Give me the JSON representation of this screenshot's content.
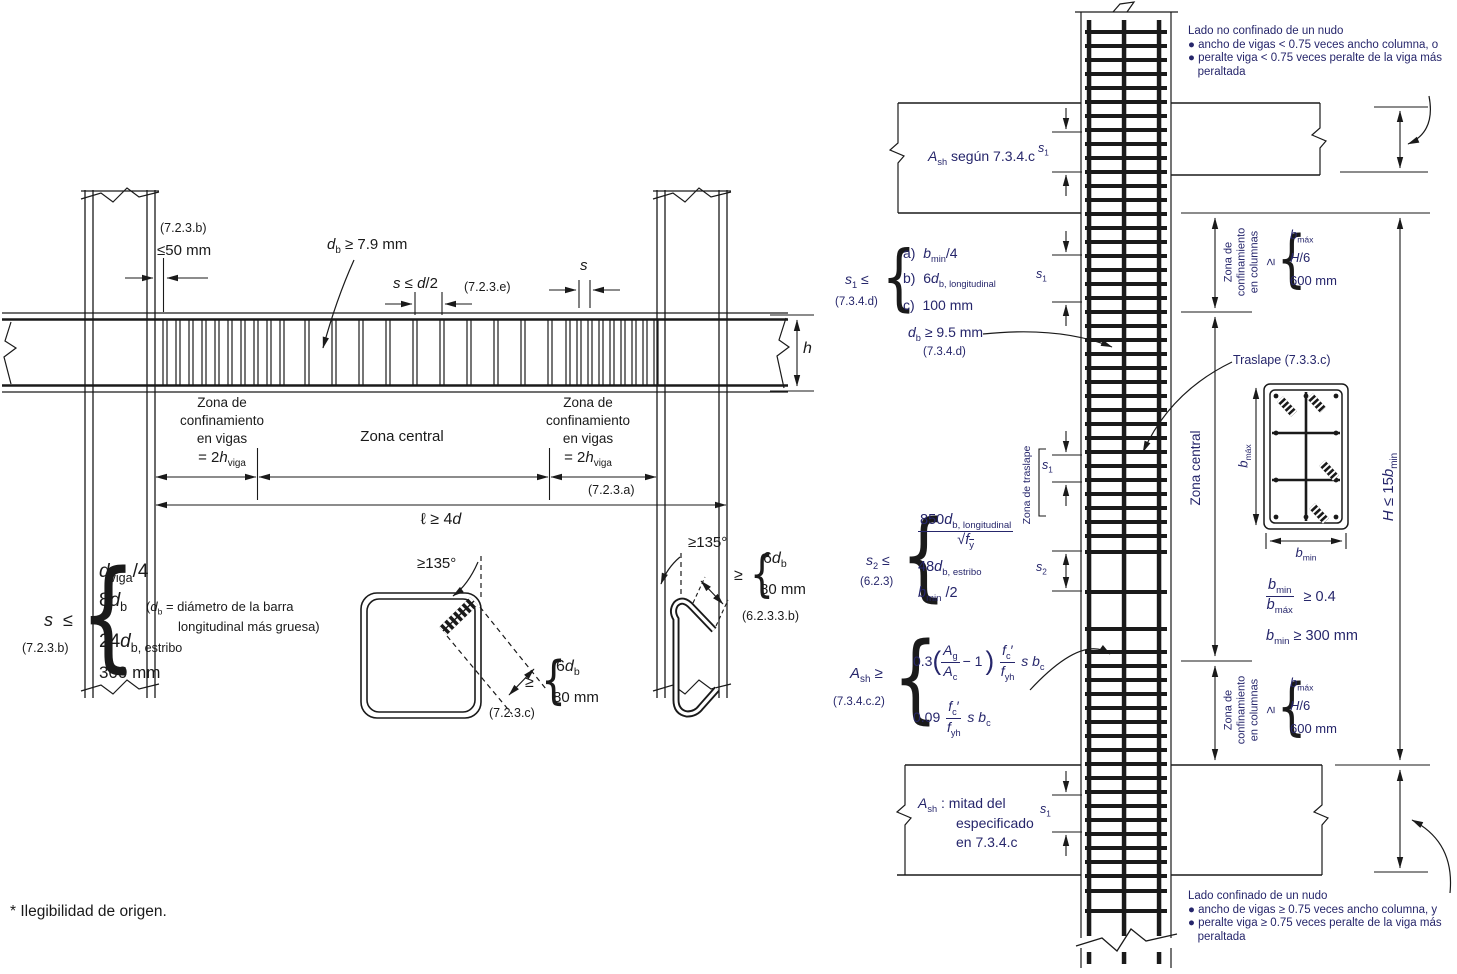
{
  "sym": {
    "lbrace": "{"
  },
  "footnote": "* Ilegibilidad de origen.",
  "beam_diagram": {
    "ref_723b_top": "(7.2.3.b)",
    "le_50mm": "≤50 mm",
    "db_min": "<i>d</i><sub>b</sub> ≥ 7.9 mm",
    "s_le_d2": "<i>s</i> ≤ <i>d</i>/2",
    "ref_723e": "(7.2.3.e)",
    "s_label": "<i>s</i>",
    "h_label": "<i>h</i>",
    "zona_conf": "Zona de<br>confinamiento<br>en vigas",
    "zona_conf_eq": "= 2<i>h</i><sub>viga</sub>",
    "zona_central": "Zona central",
    "ref_723a": "(7.2.3.a)",
    "span_min": "ℓ ≥ 4<i>d</i>",
    "s_limits": {
      "lhs": "<i>s</i>&nbsp; ≤",
      "ref": "(7.2.3.b)",
      "items": [
        "<i>d</i><sub>viga</sub>/4",
        "8<i>d</i><sub>b</sub>",
        "24<i>d</i><sub>b, estribo</sub>",
        "300 mm"
      ],
      "note_l1": "(<i>d</i><sub>b</sub> = diámetro de la barra",
      "note_l2": "longitudinal más gruesa)"
    },
    "hook_square": {
      "angle": "≥135°",
      "ge": "≥",
      "item1": "6<i>d</i><sub>b</sub>",
      "item2": "80 mm",
      "ref": "(7.2.3.c)"
    },
    "hook_tie": {
      "angle": "≥135°",
      "ge": "≥",
      "item1": "6<i>d</i><sub>b</sub>",
      "item2": "80 mm",
      "ref": "(6.2.3.3.b)"
    }
  },
  "column_diagram": {
    "top_note": "Lado no confinado de un nudo<br>● ancho de vigas &lt; 0.75 veces ancho columna, o<br>● peralte viga &lt; 0.75 veces peralte de la viga más<br>&nbsp;&nbsp;&nbsp;peraltada",
    "bottom_note": "Lado confinado de un nudo<br>● ancho de vigas ≥ 0.75 veces ancho columna, y<br>● peralte viga ≥ 0.75 veces peralte de la viga más<br>&nbsp;&nbsp;&nbsp;peraltada",
    "ash_top": "<i>A</i><sub>sh</sub> según 7.3.4.c",
    "s1": "<i>s</i><sub>1</sub>",
    "s2": "<i>s</i><sub>2</sub>",
    "s1_limits": {
      "lhs": "<i>s</i><sub>1</sub> ≤",
      "ref": "(7.3.4.d)",
      "items": [
        "a)&nbsp; <i>b</i><sub>min</sub>/4",
        "b)&nbsp; 6<i>d</i><sub>b, longitudinal</sub>",
        "c)&nbsp; 100 mm"
      ]
    },
    "db_min": "<i>d</i><sub>b</sub> ≥ 9.5 mm",
    "db_ref": "(7.3.4.d)",
    "traslape": "Traslape (7.3.3.c)",
    "zona_traslape": "Zona de traslape",
    "zona_central": "Zona central",
    "conf_zone": {
      "label": "Zona de<br>confinamiento<br>en columnas",
      "ge": "≥",
      "items": [
        "<i>b</i><sub>máx</sub>",
        "<i>H</i>/6",
        "600 mm"
      ]
    },
    "s2_limits": {
      "lhs": "<i>s</i><sub>2</sub> ≤",
      "ref": "(6.2.3)",
      "num": "850<i>d</i><sub>b, longitudinal</sub>",
      "den": "√<span class='ov'><i>f</i><sub>y</sub></span>",
      "items": [
        "48<i>d</i><sub>b, estribo</sub>",
        "<i>b</i><sub>min</sub> /2"
      ]
    },
    "ash_limits": {
      "lhs": "<i>A</i><sub>sh</sub> ≥",
      "ref": "(7.3.4.c.2)",
      "f1": "0.3<span class='bp'>(</span><span class='fr'><span class='nu'><i>A</i><sub>g</sub></span><span><i>A</i><sub>c</sub></span></span><span class='mx'>− 1</span><span class='bp'>)</span><span class='fr mlx'><span class='nu'><i>f</i><sub>c</sub>′</span><span><i>f</i><sub>yh</sub></span></span><span class='mlx'><i>s</i> <i>b</i><sub>c</sub></span>",
      "f2": "0.09<span class='fr mlx'><span class='nu'><i>f</i><sub>c</sub>′</span><span><i>f</i><sub>yh</sub></span></span><span class='mlx'><i>s</i> <i>b</i><sub>c</sub></span>"
    },
    "ash_bottom_l1": "<i>A</i><sub>sh</sub> : mitad del",
    "ash_bottom_l2": "especificado",
    "ash_bottom_l3": "en 7.3.4.c",
    "section": {
      "bmax": "<i>b</i><sub>máx</sub>",
      "bmin": "<i>b</i><sub>min</sub>"
    },
    "ratio": {
      "num": "<i>b</i><sub>min</sub>",
      "den": "<i>b</i><sub>máx</sub>",
      "rhs": "≥ 0.4"
    },
    "bmin_300": "<i>b</i><sub>min</sub> ≥ 300 mm",
    "H_limit": "<i>H</i> ≤ 15<i>b</i><sub>min</sub>"
  }
}
